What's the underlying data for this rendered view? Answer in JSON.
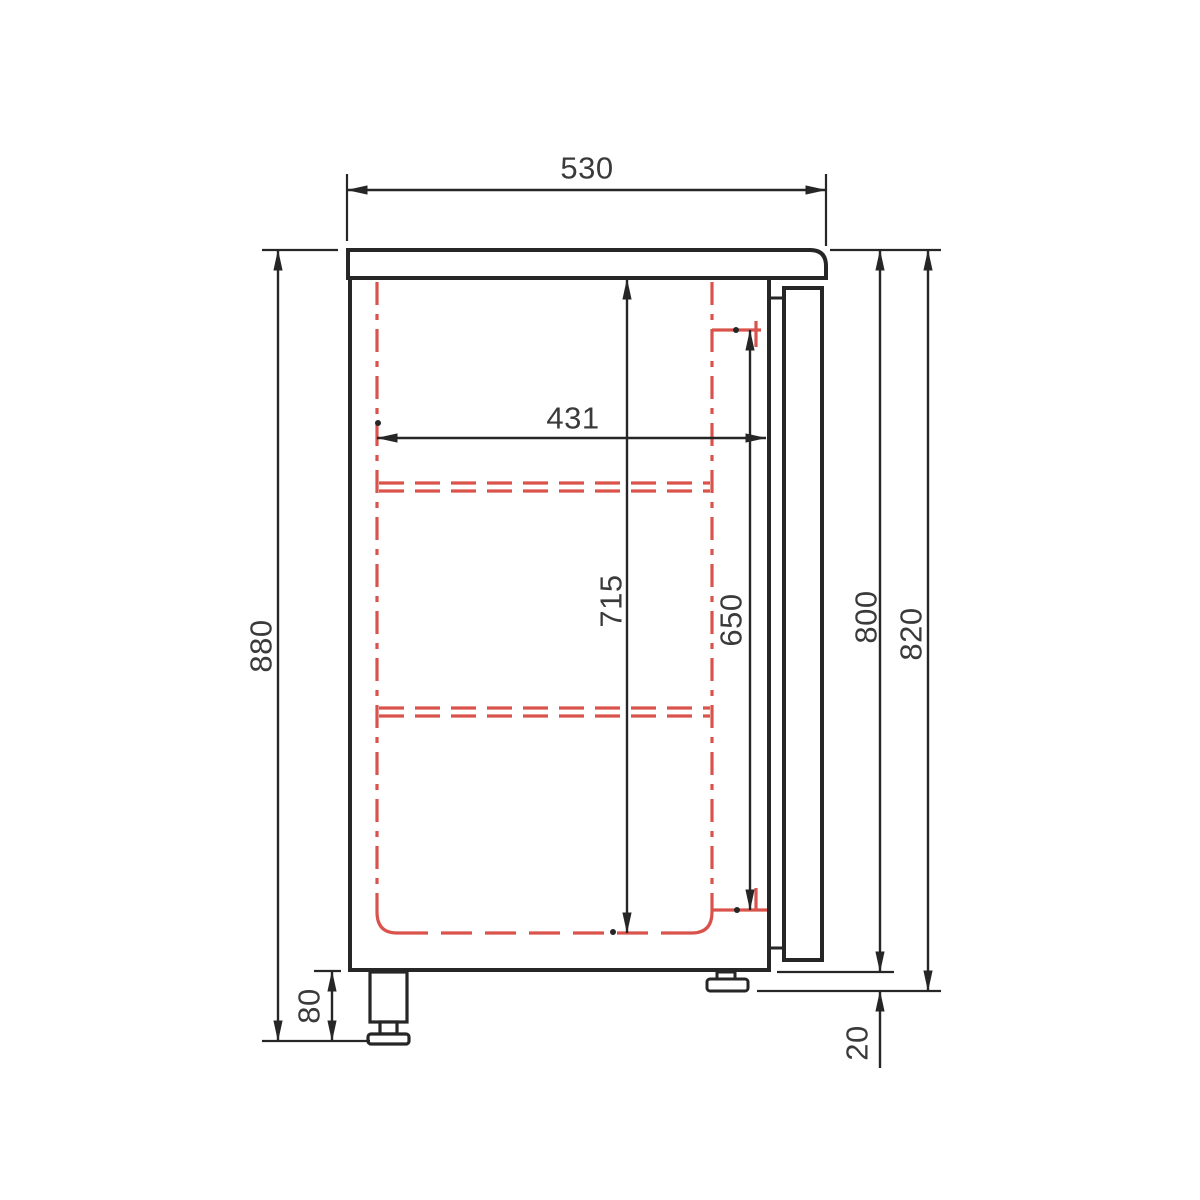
{
  "page": {
    "background": "#ffffff",
    "description": "Technical side-section drawing of a refrigerated cabinet with countertop, door, shelves and feet"
  },
  "drawing": {
    "units": "mm",
    "line_color": "#262626",
    "interior_dash_color": "#d9534c",
    "text_color": "#3a3a3a",
    "labels": {
      "top_depth": "530",
      "interior_depth": "431",
      "overall_height_with_feet": "880",
      "interior_height": "715",
      "door_opening_height": "650",
      "body_height": "800",
      "height_with_castor": "820",
      "foot_height": "80",
      "castor_height": "20"
    }
  }
}
